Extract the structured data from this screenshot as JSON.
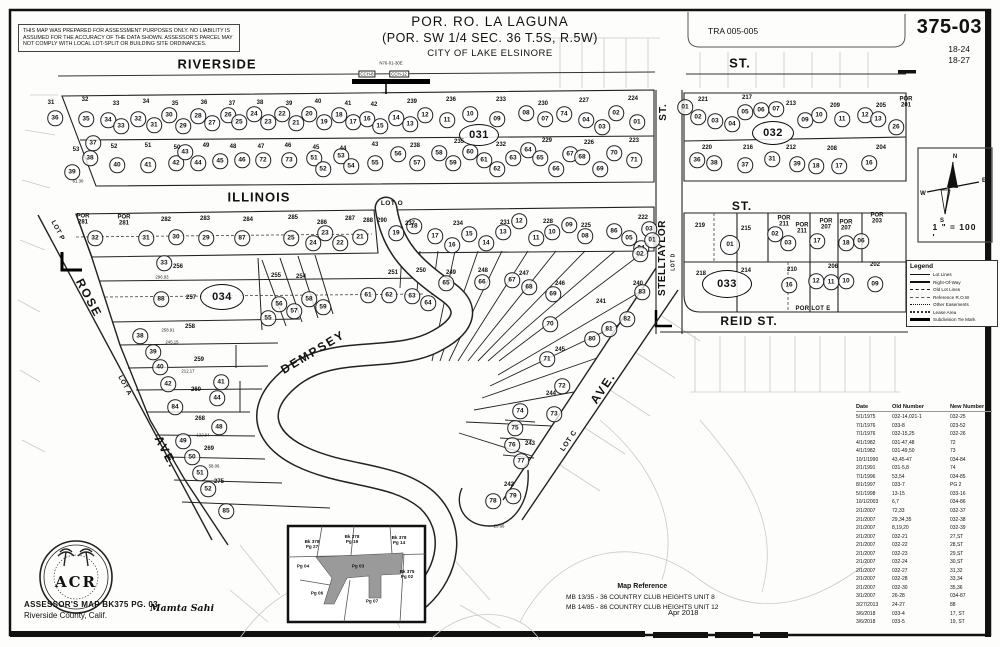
{
  "header": {
    "disclaimer": "THIS MAP WAS PREPARED FOR ASSESSMENT PURPOSES ONLY.  NO LIABILITY IS ASSUMED FOR THE ACCURACY OF THE DATA SHOWN.  ASSESSOR'S PARCEL MAY NOT COMPLY WITH LOCAL LOT-SPLIT OR BUILDING SITE ORDINANCES.",
    "title1": "POR. RO. LA LAGUNA",
    "title2": "(POR. SW 1/4 SEC. 36 T.5S, R.5W)",
    "title3": "CITY OF LAKE ELSINORE",
    "tra": "TRA 005-005",
    "sheet": "375-03",
    "page1": "18-24",
    "page2": "18-27"
  },
  "scale_text": "1 \" = 100 '",
  "compass": {
    "n": "N",
    "s": "S",
    "e": "E",
    "w": "W"
  },
  "legend": {
    "title": "Legend",
    "items": [
      {
        "label": "Lot Lines",
        "style": "thin"
      },
      {
        "label": "Right-Of-Way",
        "style": "thick"
      },
      {
        "label": "Old Lot Lines",
        "style": "dash"
      },
      {
        "label": "Reference R.O.W",
        "style": "dashdot"
      },
      {
        "label": "Other Easements",
        "style": "dots"
      },
      {
        "label": "Lease Area",
        "style": "dots2"
      },
      {
        "label": "Subdivision Tie Mark",
        "style": "block"
      }
    ]
  },
  "revision_table": {
    "headers": [
      "Date",
      "Old Number",
      "New Number"
    ],
    "rows": [
      [
        "5/1/1975",
        "032-14,021-1",
        "032-25"
      ],
      [
        "7/1/1976",
        "033-8",
        "023-52"
      ],
      [
        "7/1/1976",
        "032-15,25",
        "032-26"
      ],
      [
        "4/1/1982",
        "031-47,48",
        "72"
      ],
      [
        "4/1/1982",
        "031-49,50",
        "73"
      ],
      [
        "10/1/1990",
        "43,45-47",
        "034-84"
      ],
      [
        "2/1/1991",
        "031-5,8",
        "74"
      ],
      [
        "7/1/1996",
        "53,54",
        "034-85"
      ],
      [
        "8/1/1997",
        "033-7",
        "PG 2"
      ],
      [
        "5/1/1998",
        "13-15",
        "033-16"
      ],
      [
        "10/1/2003",
        "6,7",
        "034-86"
      ],
      [
        "2/1/2007",
        "72,33",
        "032-37"
      ],
      [
        "2/1/2007",
        "29,34,35",
        "032-38"
      ],
      [
        "2/1/2007",
        "8,19,20",
        "032-39"
      ],
      [
        "2/1/2007",
        "032-21",
        "27,ST"
      ],
      [
        "2/1/2007",
        "032-22",
        "28,ST"
      ],
      [
        "2/1/2007",
        "032-23",
        "29,ST"
      ],
      [
        "2/1/2007",
        "032-24",
        "30,ST"
      ],
      [
        "2/1/2007",
        "032-27",
        "31,32"
      ],
      [
        "2/1/2007",
        "032-28",
        "33,34"
      ],
      [
        "2/1/2007",
        "032-30",
        "35,36"
      ],
      [
        "3/1/2007",
        "26-28",
        "034-87"
      ],
      [
        "3/27/2013",
        "24-27",
        "88"
      ],
      [
        "3/6/2018",
        "033-4",
        "17, ST"
      ],
      [
        "3/6/2018",
        "033-5",
        "19, ST"
      ]
    ]
  },
  "map_reference": {
    "title": "Map Reference",
    "entries": [
      "MB  13/35 - 36   COUNTRY CLUB HEIGHTS UNIT 8",
      "MB  14/85 - 86   COUNTRY CLUB HEIGHTS UNIT 12"
    ],
    "date": "Apr 2018"
  },
  "footer": {
    "line1": "ASSESSOR'S MAP BK375 PG. 03",
    "line2": "Riverside County, Calif.",
    "signature": "Mamta Sahi",
    "seal_text": "ACR"
  },
  "inset": {
    "labels": [
      {
        "t": "Bk 378\nPg 27",
        "x": 312,
        "y": 544
      },
      {
        "t": "Bk 378\nPg 19",
        "x": 352,
        "y": 539
      },
      {
        "t": "Bk 378\nPg 14",
        "x": 399,
        "y": 540
      },
      {
        "t": "Pg 04",
        "x": 303,
        "y": 566
      },
      {
        "t": "Pg 03",
        "x": 358,
        "y": 566
      },
      {
        "t": "Bk 375\nPg 02",
        "x": 407,
        "y": 574
      },
      {
        "t": "Pg 06",
        "x": 317,
        "y": 593
      },
      {
        "t": "Pg 07",
        "x": 372,
        "y": 601
      }
    ]
  },
  "street_labels": [
    {
      "t": "RIVERSIDE",
      "x": 217,
      "y": 64,
      "s": 13,
      "r": 0,
      "ls": 1
    },
    {
      "t": "ST.",
      "x": 740,
      "y": 63,
      "s": 13,
      "r": 0,
      "ls": 1
    },
    {
      "t": "ILLINOIS",
      "x": 259,
      "y": 197,
      "s": 13,
      "r": 0,
      "ls": 1
    },
    {
      "t": "LOT O",
      "x": 392,
      "y": 204,
      "s": 6.5,
      "r": 0,
      "ls": 0.5
    },
    {
      "t": "ST.",
      "x": 742,
      "y": 206,
      "s": 12,
      "r": 0,
      "ls": 1
    },
    {
      "t": "ST.",
      "x": 664,
      "y": 112,
      "s": 10,
      "r": -90,
      "ls": 1
    },
    {
      "t": "STELLTAYLOR",
      "x": 663,
      "y": 258,
      "s": 10,
      "r": -90,
      "ls": 0.5
    },
    {
      "t": "LOT D",
      "x": 674,
      "y": 262,
      "s": 5,
      "r": -90,
      "ls": 0.5
    },
    {
      "t": "REID  ST.",
      "x": 749,
      "y": 321,
      "s": 12,
      "r": 0,
      "ls": 1
    },
    {
      "t": "POR LOT E",
      "x": 813,
      "y": 309,
      "s": 6,
      "r": 0,
      "ls": 0.3
    },
    {
      "t": "DEMPSEY",
      "x": 313,
      "y": 352,
      "s": 12,
      "r": -31,
      "ls": 2
    },
    {
      "t": "ROSE",
      "x": 89,
      "y": 298,
      "s": 12,
      "r": 62,
      "ls": 2
    },
    {
      "t": "AVE.",
      "x": 166,
      "y": 452,
      "s": 12,
      "r": 62,
      "ls": 2
    },
    {
      "t": "LOT A",
      "x": 124,
      "y": 386,
      "s": 6.5,
      "r": 62,
      "ls": 0.5
    },
    {
      "t": "LOT P",
      "x": 57,
      "y": 231,
      "s": 6.5,
      "r": 62,
      "ls": 0.5
    },
    {
      "t": "AVE.",
      "x": 603,
      "y": 388,
      "s": 12,
      "r": -56,
      "ls": 2
    },
    {
      "t": "LOT C",
      "x": 569,
      "y": 441,
      "s": 7,
      "r": -56,
      "ls": 0.5
    }
  ],
  "block_ovals": [
    {
      "n": "031",
      "x": 479,
      "y": 135,
      "w": 38,
      "h": 20
    },
    {
      "n": "032",
      "x": 773,
      "y": 133,
      "w": 40,
      "h": 22
    },
    {
      "n": "033",
      "x": 727,
      "y": 284,
      "w": 48,
      "h": 26
    },
    {
      "n": "034",
      "x": 222,
      "y": 297,
      "w": 42,
      "h": 24
    }
  ],
  "parcel_circles": [
    [
      "36",
      55,
      118
    ],
    [
      "35",
      86,
      119
    ],
    [
      "34",
      108,
      120
    ],
    [
      "33",
      121,
      126
    ],
    [
      "32",
      138,
      119
    ],
    [
      "31",
      154,
      125
    ],
    [
      "30",
      169,
      115
    ],
    [
      "29",
      183,
      126
    ],
    [
      "28",
      198,
      116
    ],
    [
      "27",
      212,
      123
    ],
    [
      "26",
      228,
      115
    ],
    [
      "25",
      239,
      122
    ],
    [
      "24",
      254,
      114
    ],
    [
      "23",
      268,
      122
    ],
    [
      "22",
      282,
      114
    ],
    [
      "21",
      296,
      123
    ],
    [
      "20",
      309,
      114
    ],
    [
      "19",
      324,
      122
    ],
    [
      "18",
      339,
      115
    ],
    [
      "17",
      353,
      122
    ],
    [
      "16",
      367,
      119
    ],
    [
      "15",
      380,
      126
    ],
    [
      "14",
      396,
      118
    ],
    [
      "13",
      410,
      124
    ],
    [
      "12",
      425,
      115
    ],
    [
      "11",
      447,
      120
    ],
    [
      "10",
      470,
      114
    ],
    [
      "09",
      497,
      119
    ],
    [
      "08",
      526,
      113
    ],
    [
      "07",
      545,
      119
    ],
    [
      "74",
      564,
      114
    ],
    [
      "04",
      586,
      120
    ],
    [
      "03",
      602,
      127
    ],
    [
      "02",
      616,
      113
    ],
    [
      "01",
      637,
      122
    ],
    [
      "37",
      93,
      143
    ],
    [
      "38",
      90,
      158
    ],
    [
      "39",
      72,
      172
    ],
    [
      "40",
      117,
      165
    ],
    [
      "41",
      148,
      165
    ],
    [
      "42",
      176,
      163
    ],
    [
      "43",
      185,
      152
    ],
    [
      "44",
      198,
      163
    ],
    [
      "45",
      220,
      161
    ],
    [
      "46",
      242,
      160
    ],
    [
      "72",
      263,
      160
    ],
    [
      "73",
      289,
      160
    ],
    [
      "51",
      314,
      158
    ],
    [
      "52",
      323,
      169
    ],
    [
      "53",
      341,
      156
    ],
    [
      "54",
      351,
      166
    ],
    [
      "55",
      375,
      163
    ],
    [
      "56",
      398,
      154
    ],
    [
      "57",
      417,
      163
    ],
    [
      "58",
      439,
      153
    ],
    [
      "59",
      453,
      163
    ],
    [
      "60",
      470,
      152
    ],
    [
      "61",
      484,
      160
    ],
    [
      "62",
      497,
      169
    ],
    [
      "63",
      513,
      158
    ],
    [
      "64",
      528,
      150
    ],
    [
      "65",
      540,
      158
    ],
    [
      "66",
      556,
      169
    ],
    [
      "67",
      570,
      154
    ],
    [
      "68",
      582,
      157
    ],
    [
      "69",
      600,
      169
    ],
    [
      "70",
      614,
      153
    ],
    [
      "71",
      634,
      160
    ],
    [
      "01",
      685,
      107
    ],
    [
      "02",
      698,
      117
    ],
    [
      "03",
      715,
      121
    ],
    [
      "04",
      732,
      124
    ],
    [
      "05",
      745,
      112
    ],
    [
      "06",
      761,
      110
    ],
    [
      "07",
      776,
      109
    ],
    [
      "09",
      805,
      120
    ],
    [
      "10",
      819,
      115
    ],
    [
      "11",
      842,
      119
    ],
    [
      "12",
      865,
      115
    ],
    [
      "13",
      878,
      119
    ],
    [
      "26",
      896,
      127
    ],
    [
      "36",
      697,
      160
    ],
    [
      "38",
      714,
      163
    ],
    [
      "37",
      745,
      165
    ],
    [
      "31",
      772,
      159
    ],
    [
      "39",
      797,
      164
    ],
    [
      "18",
      816,
      166
    ],
    [
      "17",
      839,
      166
    ],
    [
      "16",
      869,
      163
    ],
    [
      "01",
      730,
      245,
      18
    ],
    [
      "02",
      775,
      234
    ],
    [
      "03",
      788,
      243
    ],
    [
      "17",
      817,
      241
    ],
    [
      "18",
      846,
      243
    ],
    [
      "06",
      861,
      241
    ],
    [
      "16",
      789,
      285
    ],
    [
      "12",
      816,
      281
    ],
    [
      "11",
      831,
      282
    ],
    [
      "10",
      846,
      281
    ],
    [
      "09",
      875,
      284
    ],
    [
      "19",
      396,
      233
    ],
    [
      "18",
      414,
      226
    ],
    [
      "17",
      435,
      236
    ],
    [
      "16",
      452,
      245
    ],
    [
      "15",
      469,
      234
    ],
    [
      "14",
      486,
      243
    ],
    [
      "13",
      503,
      232
    ],
    [
      "12",
      519,
      221
    ],
    [
      "11",
      536,
      238
    ],
    [
      "10",
      552,
      232
    ],
    [
      "09",
      569,
      225
    ],
    [
      "08",
      585,
      236
    ],
    [
      "86",
      614,
      231
    ],
    [
      "05",
      629,
      238
    ],
    [
      "04",
      641,
      248
    ],
    [
      "03",
      649,
      229
    ],
    [
      "02",
      640,
      254
    ],
    [
      "01",
      652,
      240
    ],
    [
      "32",
      95,
      238
    ],
    [
      "31",
      146,
      238
    ],
    [
      "30",
      176,
      237
    ],
    [
      "29",
      206,
      238
    ],
    [
      "87",
      242,
      238
    ],
    [
      "25",
      291,
      238
    ],
    [
      "24",
      313,
      243
    ],
    [
      "23",
      325,
      233
    ],
    [
      "22",
      340,
      243
    ],
    [
      "21",
      360,
      237
    ],
    [
      "33",
      164,
      263
    ],
    [
      "88",
      161,
      299
    ],
    [
      "38",
      140,
      336
    ],
    [
      "55",
      268,
      318
    ],
    [
      "56",
      279,
      304
    ],
    [
      "57",
      294,
      311
    ],
    [
      "58",
      309,
      299
    ],
    [
      "59",
      323,
      307
    ],
    [
      "39",
      153,
      352
    ],
    [
      "40",
      160,
      367
    ],
    [
      "42",
      168,
      384
    ],
    [
      "84",
      175,
      407
    ],
    [
      "49",
      183,
      441
    ],
    [
      "50",
      192,
      457
    ],
    [
      "51",
      200,
      473
    ],
    [
      "52",
      208,
      489
    ],
    [
      "85",
      226,
      511
    ],
    [
      "41",
      221,
      382
    ],
    [
      "44",
      217,
      398
    ],
    [
      "48",
      219,
      427
    ],
    [
      "61",
      368,
      295
    ],
    [
      "62",
      389,
      295
    ],
    [
      "63",
      412,
      296
    ],
    [
      "64",
      428,
      303
    ],
    [
      "65",
      446,
      283
    ],
    [
      "66",
      482,
      282
    ],
    [
      "67",
      512,
      280
    ],
    [
      "68",
      529,
      287
    ],
    [
      "69",
      553,
      294
    ],
    [
      "70",
      550,
      324
    ],
    [
      "71",
      547,
      359
    ],
    [
      "72",
      562,
      386
    ],
    [
      "73",
      554,
      414
    ],
    [
      "74",
      520,
      411
    ],
    [
      "75",
      515,
      428
    ],
    [
      "76",
      512,
      445
    ],
    [
      "77",
      521,
      461
    ],
    [
      "78",
      493,
      501
    ],
    [
      "79",
      513,
      496
    ],
    [
      "80",
      592,
      339
    ],
    [
      "81",
      609,
      329
    ],
    [
      "82",
      627,
      319
    ],
    [
      "83",
      642,
      292
    ]
  ],
  "lot_labels": [
    [
      "31",
      51,
      103
    ],
    [
      "32",
      85,
      100
    ],
    [
      "33",
      116,
      104
    ],
    [
      "34",
      146,
      102
    ],
    [
      "35",
      175,
      104
    ],
    [
      "36",
      204,
      103
    ],
    [
      "37",
      232,
      104
    ],
    [
      "38",
      260,
      103
    ],
    [
      "39",
      289,
      104
    ],
    [
      "40",
      318,
      102
    ],
    [
      "41",
      348,
      104
    ],
    [
      "42",
      374,
      105
    ],
    [
      "239",
      412,
      102
    ],
    [
      "236",
      451,
      100
    ],
    [
      "233",
      501,
      100
    ],
    [
      "230",
      543,
      104
    ],
    [
      "227",
      584,
      101
    ],
    [
      "224",
      633,
      99
    ],
    [
      "53",
      76,
      150
    ],
    [
      "52",
      114,
      147
    ],
    [
      "51",
      148,
      146
    ],
    [
      "50",
      177,
      148
    ],
    [
      "49",
      206,
      146
    ],
    [
      "48",
      233,
      147
    ],
    [
      "47",
      261,
      147
    ],
    [
      "46",
      288,
      146
    ],
    [
      "45",
      316,
      148
    ],
    [
      "44",
      343,
      149
    ],
    [
      "43",
      375,
      145
    ],
    [
      "238",
      415,
      146
    ],
    [
      "235",
      459,
      142
    ],
    [
      "232",
      501,
      145
    ],
    [
      "229",
      547,
      141
    ],
    [
      "226",
      589,
      143
    ],
    [
      "223",
      634,
      141
    ],
    [
      "221",
      703,
      100
    ],
    [
      "217",
      747,
      98
    ],
    [
      "213",
      791,
      104
    ],
    [
      "209",
      835,
      106
    ],
    [
      "205",
      881,
      106
    ],
    [
      "POR\n201",
      906,
      103
    ],
    [
      "220",
      707,
      148
    ],
    [
      "216",
      748,
      148
    ],
    [
      "212",
      791,
      148
    ],
    [
      "208",
      832,
      149
    ],
    [
      "204",
      881,
      148
    ],
    [
      "219",
      700,
      226
    ],
    [
      "215",
      746,
      229
    ],
    [
      "POR\n211",
      784,
      222
    ],
    [
      "POR\n211",
      802,
      229
    ],
    [
      "POR\n207",
      826,
      225
    ],
    [
      "POR\n207",
      846,
      226
    ],
    [
      "POR\n203",
      877,
      219
    ],
    [
      "218",
      701,
      274
    ],
    [
      "214",
      746,
      271
    ],
    [
      "210",
      792,
      270
    ],
    [
      "206",
      833,
      267
    ],
    [
      "202",
      875,
      265
    ],
    [
      "290",
      382,
      221
    ],
    [
      "237",
      410,
      224
    ],
    [
      "234",
      458,
      224
    ],
    [
      "231",
      505,
      223
    ],
    [
      "228",
      548,
      222
    ],
    [
      "225",
      586,
      226
    ],
    [
      "222",
      643,
      218
    ],
    [
      "POR\n281",
      83,
      220
    ],
    [
      "POR\n281",
      124,
      221
    ],
    [
      "282",
      166,
      220
    ],
    [
      "283",
      205,
      219
    ],
    [
      "284",
      248,
      220
    ],
    [
      "285",
      293,
      218
    ],
    [
      "286",
      322,
      223
    ],
    [
      "287",
      350,
      219
    ],
    [
      "288",
      368,
      221
    ],
    [
      "256",
      178,
      267
    ],
    [
      "257",
      191,
      298
    ],
    [
      "258",
      190,
      327
    ],
    [
      "259",
      199,
      360
    ],
    [
      "260",
      196,
      390
    ],
    [
      "268",
      200,
      419
    ],
    [
      "269",
      209,
      449
    ],
    [
      "275",
      219,
      482
    ],
    [
      "255",
      276,
      276
    ],
    [
      "254",
      301,
      277
    ],
    [
      "251",
      393,
      273
    ],
    [
      "250",
      421,
      271
    ],
    [
      "249",
      451,
      273
    ],
    [
      "248",
      483,
      271
    ],
    [
      "247",
      524,
      274
    ],
    [
      "246",
      560,
      284
    ],
    [
      "245",
      560,
      350
    ],
    [
      "244",
      551,
      394
    ],
    [
      "243",
      530,
      444
    ],
    [
      "242",
      509,
      485
    ],
    [
      "241",
      601,
      302
    ],
    [
      "240",
      638,
      284
    ]
  ],
  "dim_labels": [
    [
      "296.93",
      162,
      277
    ],
    [
      "258.91",
      168,
      330
    ],
    [
      "245.15",
      172,
      342
    ],
    [
      "212.17",
      188,
      371
    ],
    [
      "122.94",
      203,
      435
    ],
    [
      "58.06",
      214,
      466
    ],
    [
      "61.30",
      78,
      181
    ],
    [
      "20.66",
      499,
      526
    ],
    [
      "N76-01-30E",
      391,
      63
    ]
  ],
  "tie_boxes": [
    [
      "CCH-8",
      367,
      74
    ],
    [
      "CCH-12",
      399,
      74
    ]
  ]
}
